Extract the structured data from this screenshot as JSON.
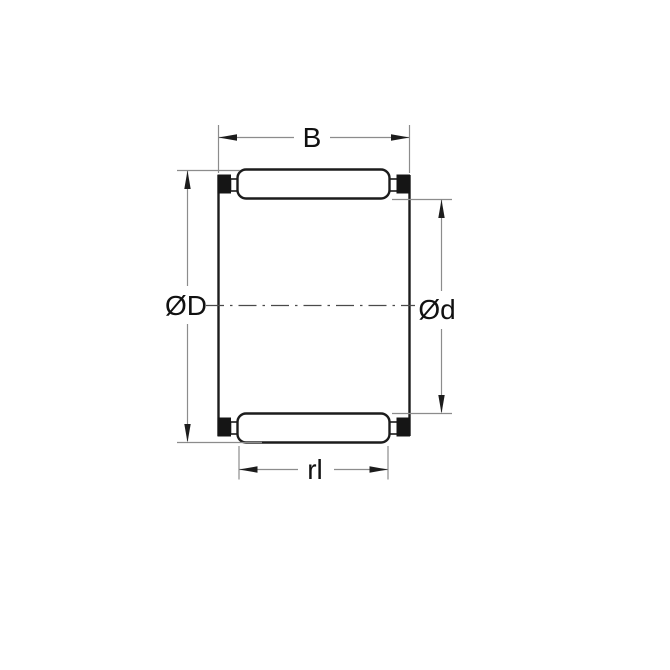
{
  "diagram": {
    "kind": "needle-roller-bearing-cross-section"
  },
  "labels": {
    "width": "B",
    "outer_diameter": "ØD",
    "inner_diameter": "Ød",
    "roller_length": "rl"
  },
  "colors": {
    "background": "#ffffff",
    "outline": "#1c1c1c",
    "dimension_line": "#8c8c8c",
    "centerline": "#4a4a4a",
    "cage_fill": "#151515",
    "label_text": "#111111"
  }
}
